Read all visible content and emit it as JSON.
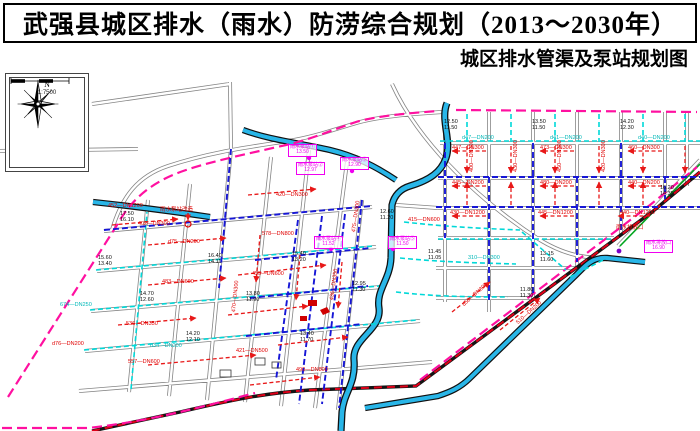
{
  "header": {
    "title": "武强县城区排水（雨水）防涝综合规划（2013～2030年）",
    "subtitle": "城区排水管渠及泵站规划图"
  },
  "compass": {
    "north_label": "N",
    "scale_text": "1:7500"
  },
  "colors": {
    "boundary_pink": "#ff10a0",
    "channel_blue": "#29b6e8",
    "pipe_red": "#e81818",
    "pipe_cyan": "#00d8d8",
    "pipe_blue": "#1616d6",
    "railway_red": "#e00018",
    "road_gray": "#808080",
    "green_line": "#00a51e",
    "pump_magenta": "#f000f0"
  },
  "map": {
    "labels": [
      {
        "t": "447—DN300",
        "x": 452,
        "y": 146
      },
      {
        "t": "473—DN300",
        "x": 540,
        "y": 146
      },
      {
        "t": "460—DN300",
        "x": 628,
        "y": 146
      },
      {
        "t": "445—DN200",
        "x": 452,
        "y": 181
      },
      {
        "t": "480—DN200",
        "x": 540,
        "y": 181
      },
      {
        "t": "440—DN200",
        "x": 628,
        "y": 181
      },
      {
        "t": "430—DN1200",
        "x": 450,
        "y": 211
      },
      {
        "t": "445—DN1200",
        "x": 538,
        "y": 211
      },
      {
        "t": "440—DN1200",
        "x": 620,
        "y": 211
      },
      {
        "t": "400—DN300",
        "x": 470,
        "y": 172,
        "r": -90
      },
      {
        "t": "430—DN300",
        "x": 514,
        "y": 172,
        "r": -90
      },
      {
        "t": "450—DN300",
        "x": 558,
        "y": 172,
        "r": -90
      },
      {
        "t": "420—DN300",
        "x": 602,
        "y": 172,
        "r": -90
      },
      {
        "t": "d75—DN200",
        "x": 168,
        "y": 240
      },
      {
        "t": "483—DN600",
        "x": 162,
        "y": 280
      },
      {
        "t": "402—DN300",
        "x": 138,
        "y": 222
      },
      {
        "t": "536—DN350",
        "x": 126,
        "y": 322
      },
      {
        "t": "d76—DN200",
        "x": 52,
        "y": 342
      },
      {
        "t": "455—DN600",
        "x": 252,
        "y": 272
      },
      {
        "t": "470—DN300",
        "x": 232,
        "y": 312,
        "r": -84
      },
      {
        "t": "420—DN300",
        "x": 276,
        "y": 193
      },
      {
        "t": "557—DN600",
        "x": 128,
        "y": 360
      },
      {
        "t": "452—DN1200",
        "x": 108,
        "y": 204
      },
      {
        "t": "475—DN300",
        "x": 352,
        "y": 232,
        "r": -82
      },
      {
        "t": "415—DN600",
        "x": 408,
        "y": 218
      },
      {
        "t": "436—DN350",
        "x": 330,
        "y": 300,
        "r": -82
      },
      {
        "t": "490—DN800",
        "x": 296,
        "y": 368
      },
      {
        "t": "421—DN500",
        "x": 236,
        "y": 349
      },
      {
        "t": "d50—DN300",
        "x": 462,
        "y": 304,
        "r": -42
      },
      {
        "t": "510—DN200",
        "x": 516,
        "y": 322,
        "r": -42
      },
      {
        "t": "578—DN800",
        "x": 262,
        "y": 232
      },
      {
        "t": "雨水泵站改造",
        "x": 160,
        "y": 208,
        "n": "pump-rebuild-label"
      },
      {
        "t": "雨水排放口",
        "x": 616,
        "y": 226,
        "n": "outfall-label"
      },
      {
        "t": "d47—DN200",
        "x": 462,
        "y": 136,
        "c": "cyan"
      },
      {
        "t": "d41—DN200",
        "x": 550,
        "y": 136,
        "c": "cyan"
      },
      {
        "t": "d40—DN200",
        "x": 638,
        "y": 136,
        "c": "cyan"
      },
      {
        "t": "674—DN250",
        "x": 60,
        "y": 303,
        "c": "cyan"
      },
      {
        "t": "d34—DN200",
        "x": 150,
        "y": 344,
        "c": "cyan"
      },
      {
        "t": "310—DN300",
        "x": 468,
        "y": 256,
        "c": "cyan"
      },
      {
        "t": "12.50\n11.50",
        "x": 444,
        "y": 120,
        "c": "black"
      },
      {
        "t": "13.50\n11.50",
        "x": 532,
        "y": 120,
        "c": "black"
      },
      {
        "t": "14.20\n12.30",
        "x": 620,
        "y": 120,
        "c": "black"
      },
      {
        "t": "17.50\n16.10",
        "x": 120,
        "y": 212,
        "c": "black"
      },
      {
        "t": "16.40\n14.11",
        "x": 208,
        "y": 254,
        "c": "black"
      },
      {
        "t": "15.40\n13.20",
        "x": 292,
        "y": 252,
        "c": "black"
      },
      {
        "t": "14.70\n12.60",
        "x": 140,
        "y": 292,
        "c": "black"
      },
      {
        "t": "13.80\n11.90",
        "x": 246,
        "y": 292,
        "c": "black"
      },
      {
        "t": "12.95\n11.30",
        "x": 352,
        "y": 282,
        "c": "black"
      },
      {
        "t": "11.45\n11.05",
        "x": 428,
        "y": 250,
        "c": "black"
      },
      {
        "t": "13.15\n11.60",
        "x": 540,
        "y": 252,
        "c": "black"
      },
      {
        "t": "16.20\n14.35",
        "x": 660,
        "y": 186,
        "c": "black"
      },
      {
        "t": "14.20\n12.10",
        "x": 186,
        "y": 332,
        "c": "black"
      },
      {
        "t": "13.40\n11.70",
        "x": 300,
        "y": 332,
        "c": "black"
      },
      {
        "t": "12.60\n11.20",
        "x": 380,
        "y": 210,
        "c": "black"
      },
      {
        "t": "15.60\n13.40",
        "x": 98,
        "y": 256,
        "c": "black"
      },
      {
        "t": "11.80\n11.30",
        "x": 520,
        "y": 288,
        "c": "black"
      },
      {
        "t": "雨水泵站①\n13.50",
        "x": 288,
        "y": 144,
        "c": "magenta",
        "b": 1,
        "n": "pump-station-label"
      },
      {
        "t": "雨水泵站②\n12.97",
        "x": 296,
        "y": 162,
        "c": "magenta",
        "b": 1,
        "n": "pump-station-label"
      },
      {
        "t": "雨水泵站③\n12.90",
        "x": 340,
        "y": 157,
        "c": "magenta",
        "b": 1,
        "n": "pump-station-label"
      },
      {
        "t": "雨水泵站④\n11.52",
        "x": 314,
        "y": 236,
        "c": "magenta",
        "b": 1,
        "n": "pump-station-label"
      },
      {
        "t": "雨水泵站⑤\n11.50",
        "x": 388,
        "y": 236,
        "c": "magenta",
        "b": 1,
        "n": "pump-station-label"
      },
      {
        "t": "雨水排放口\n16.90",
        "x": 644,
        "y": 240,
        "c": "magenta",
        "b": 1,
        "n": "outfall-label"
      }
    ]
  }
}
